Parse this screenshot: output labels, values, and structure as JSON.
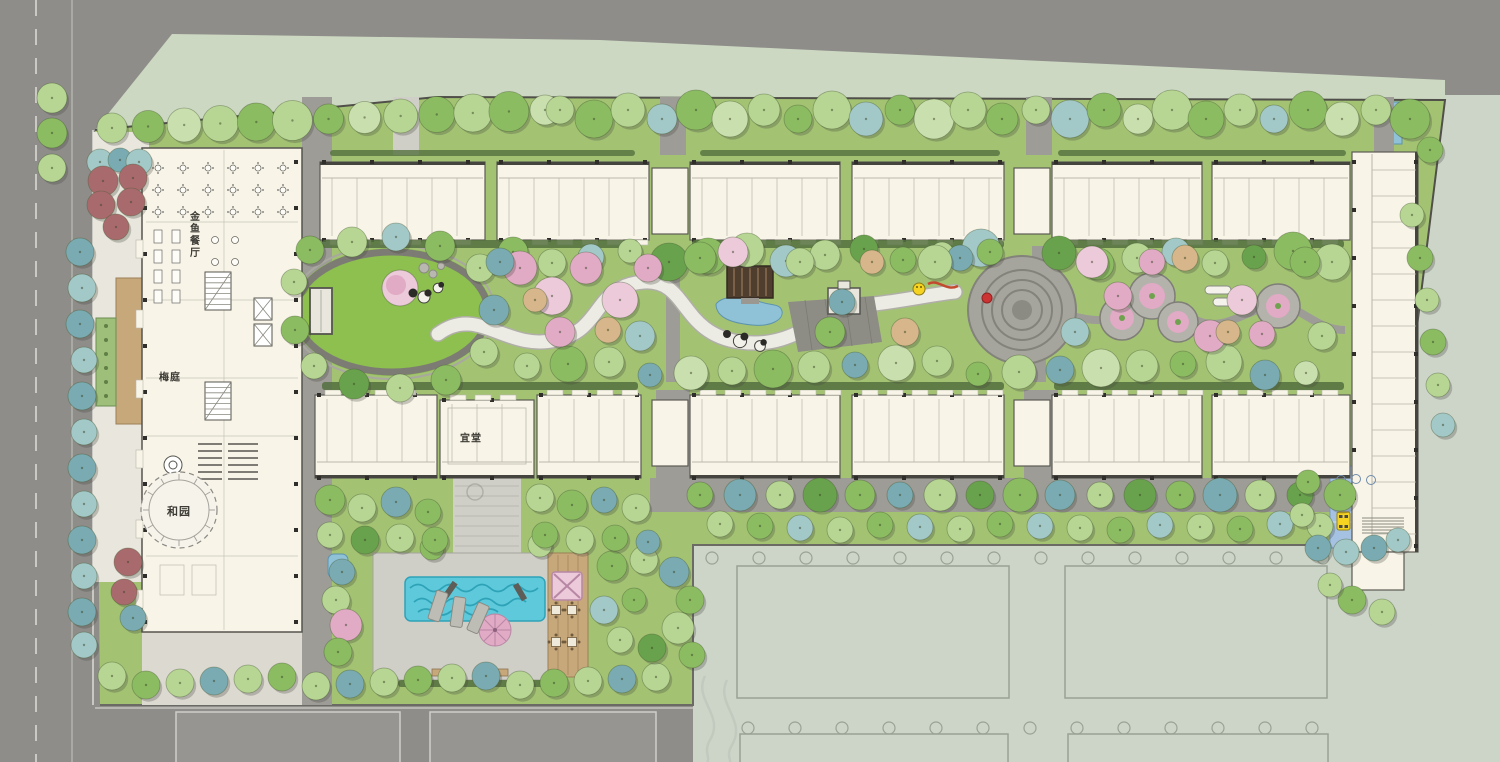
{
  "plan": {
    "type": "landscape-architecture-site-plan",
    "labels": {
      "restaurant": "金鱼餐厅",
      "plum_court": "梅庭",
      "he_garden": "和园",
      "yi_hall": "宜堂"
    },
    "palette": {
      "lawn": "#a3c373",
      "lawn_bright": "#8dc04e",
      "road": "#8e8d89",
      "road_light": "#9d9c96",
      "sage": "#cdd5c9",
      "band": "#ccd8c2",
      "cream": "#f8f4e8",
      "line": "#55544e",
      "tree_light": "#b7d693",
      "tree_pale": "#cadfae",
      "tree_med": "#8cbc62",
      "tree_dark": "#69a24c",
      "hedge": "#54703e",
      "teal": "#7aabb2",
      "teal_light": "#a3c8c8",
      "pink": "#e1aac5",
      "pink_light": "#eccada",
      "tan": "#d6b68a",
      "maroon": "#a96a6e",
      "pool": "#5ec9da",
      "pond": "#8fc2d7",
      "wood": "#c7a87b",
      "pavilion": "#4f3d2e",
      "pad": "#a5c2e3",
      "bus": "#f5d320",
      "deck": "#cfcec7",
      "walk": "#e8e6dd",
      "outline": "#99a294"
    }
  }
}
